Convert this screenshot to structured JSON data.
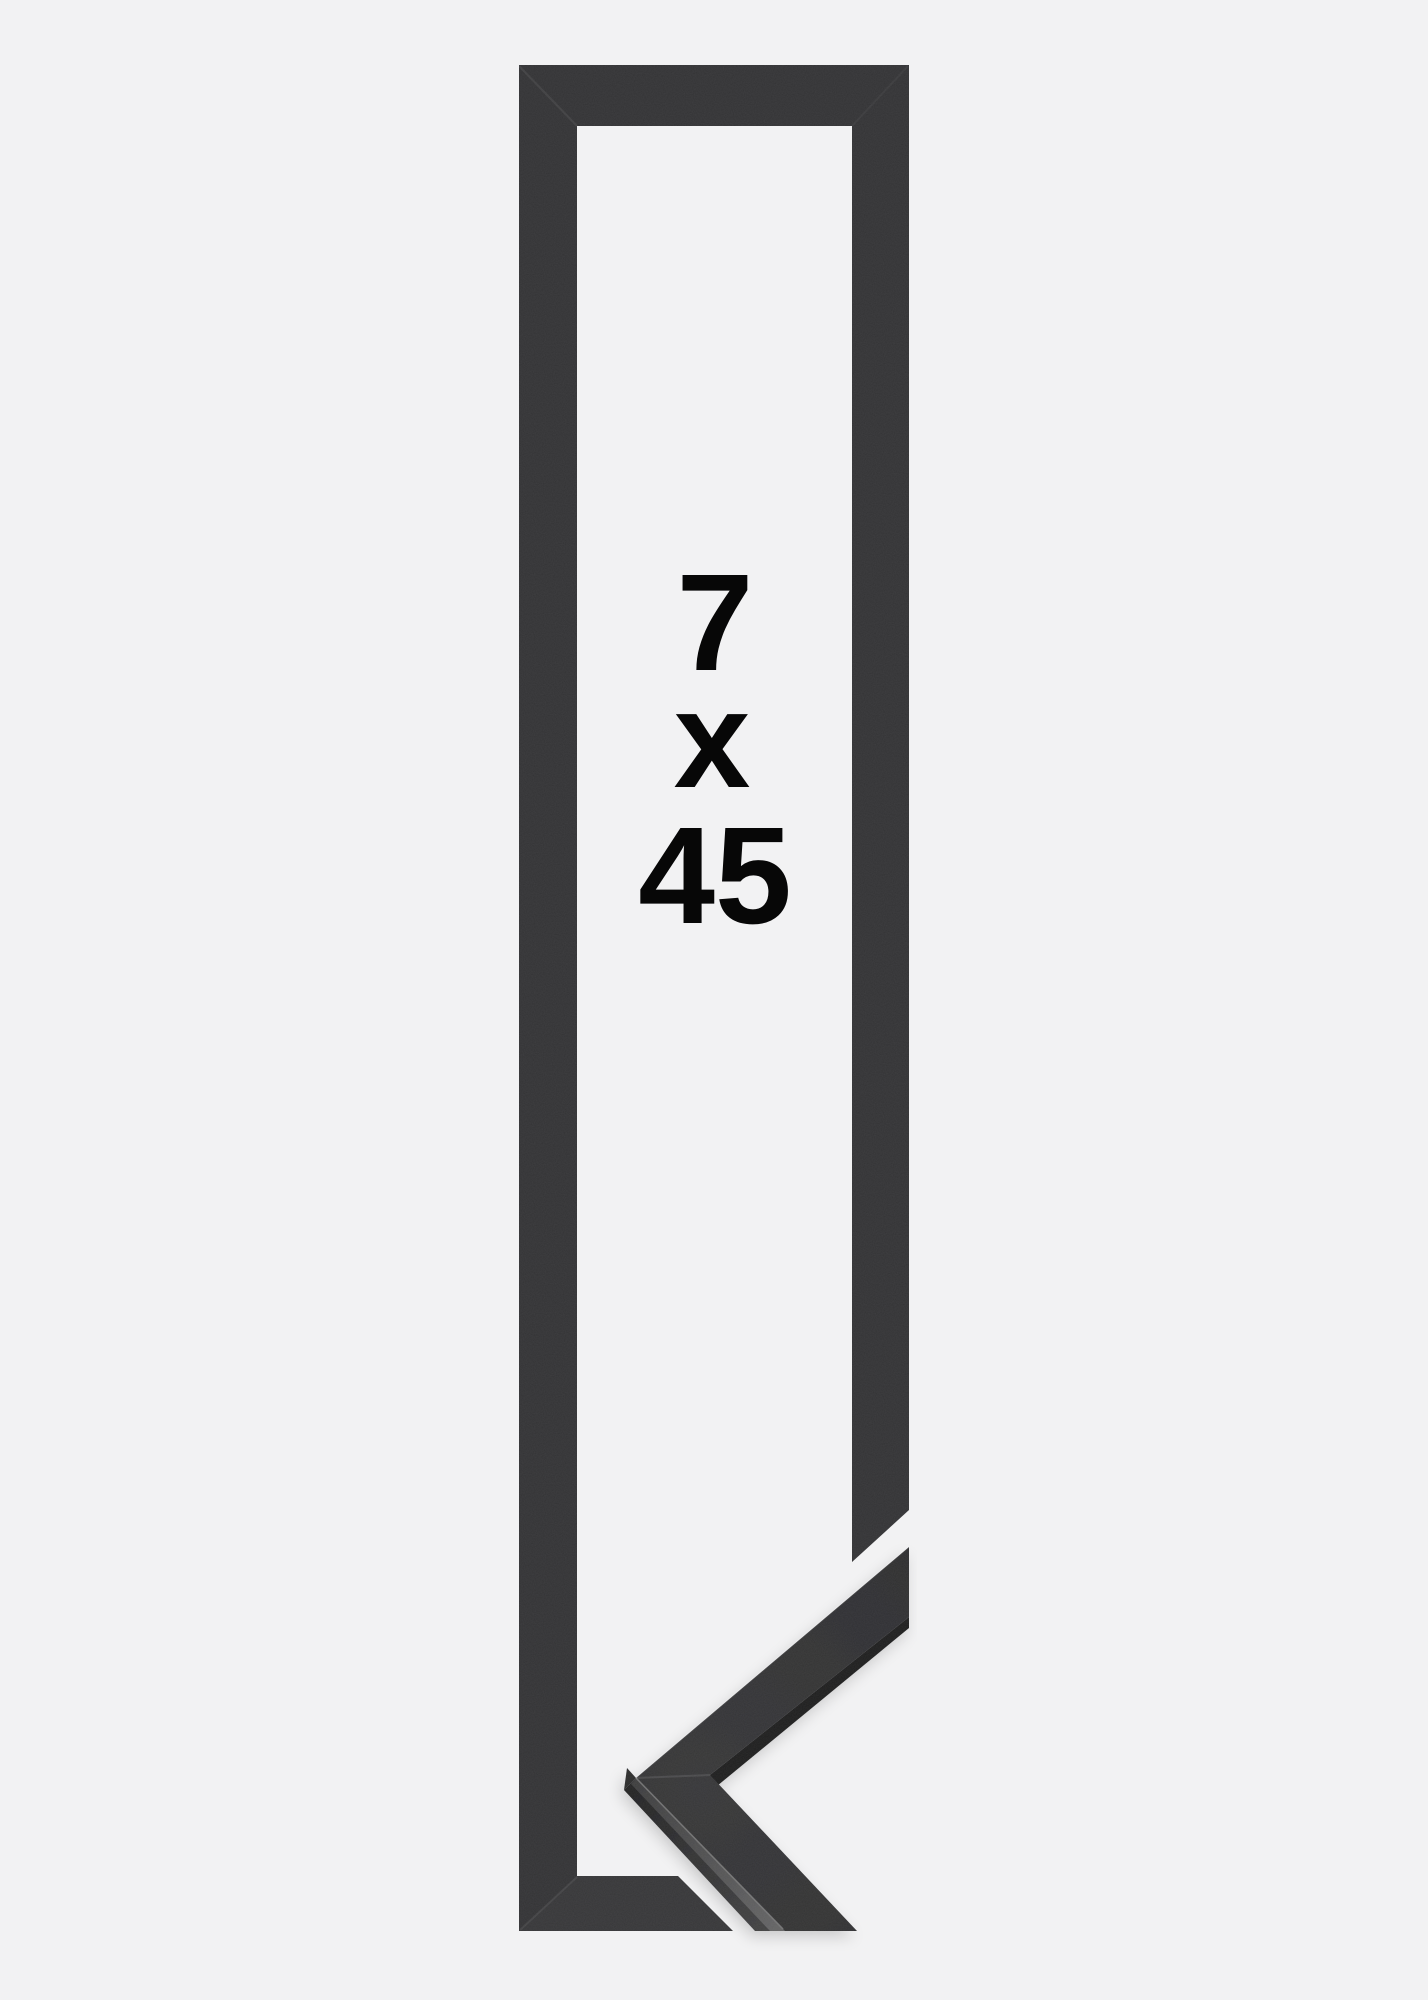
{
  "product_image": {
    "size_label": {
      "width": "7",
      "separator": "x",
      "height": "45"
    }
  },
  "colors": {
    "background": "#f2f2f3",
    "frame": "#313133",
    "moulding_edge_dark": "#1e1e1f",
    "apex_face": "#29292a",
    "label_text": "#070707"
  }
}
